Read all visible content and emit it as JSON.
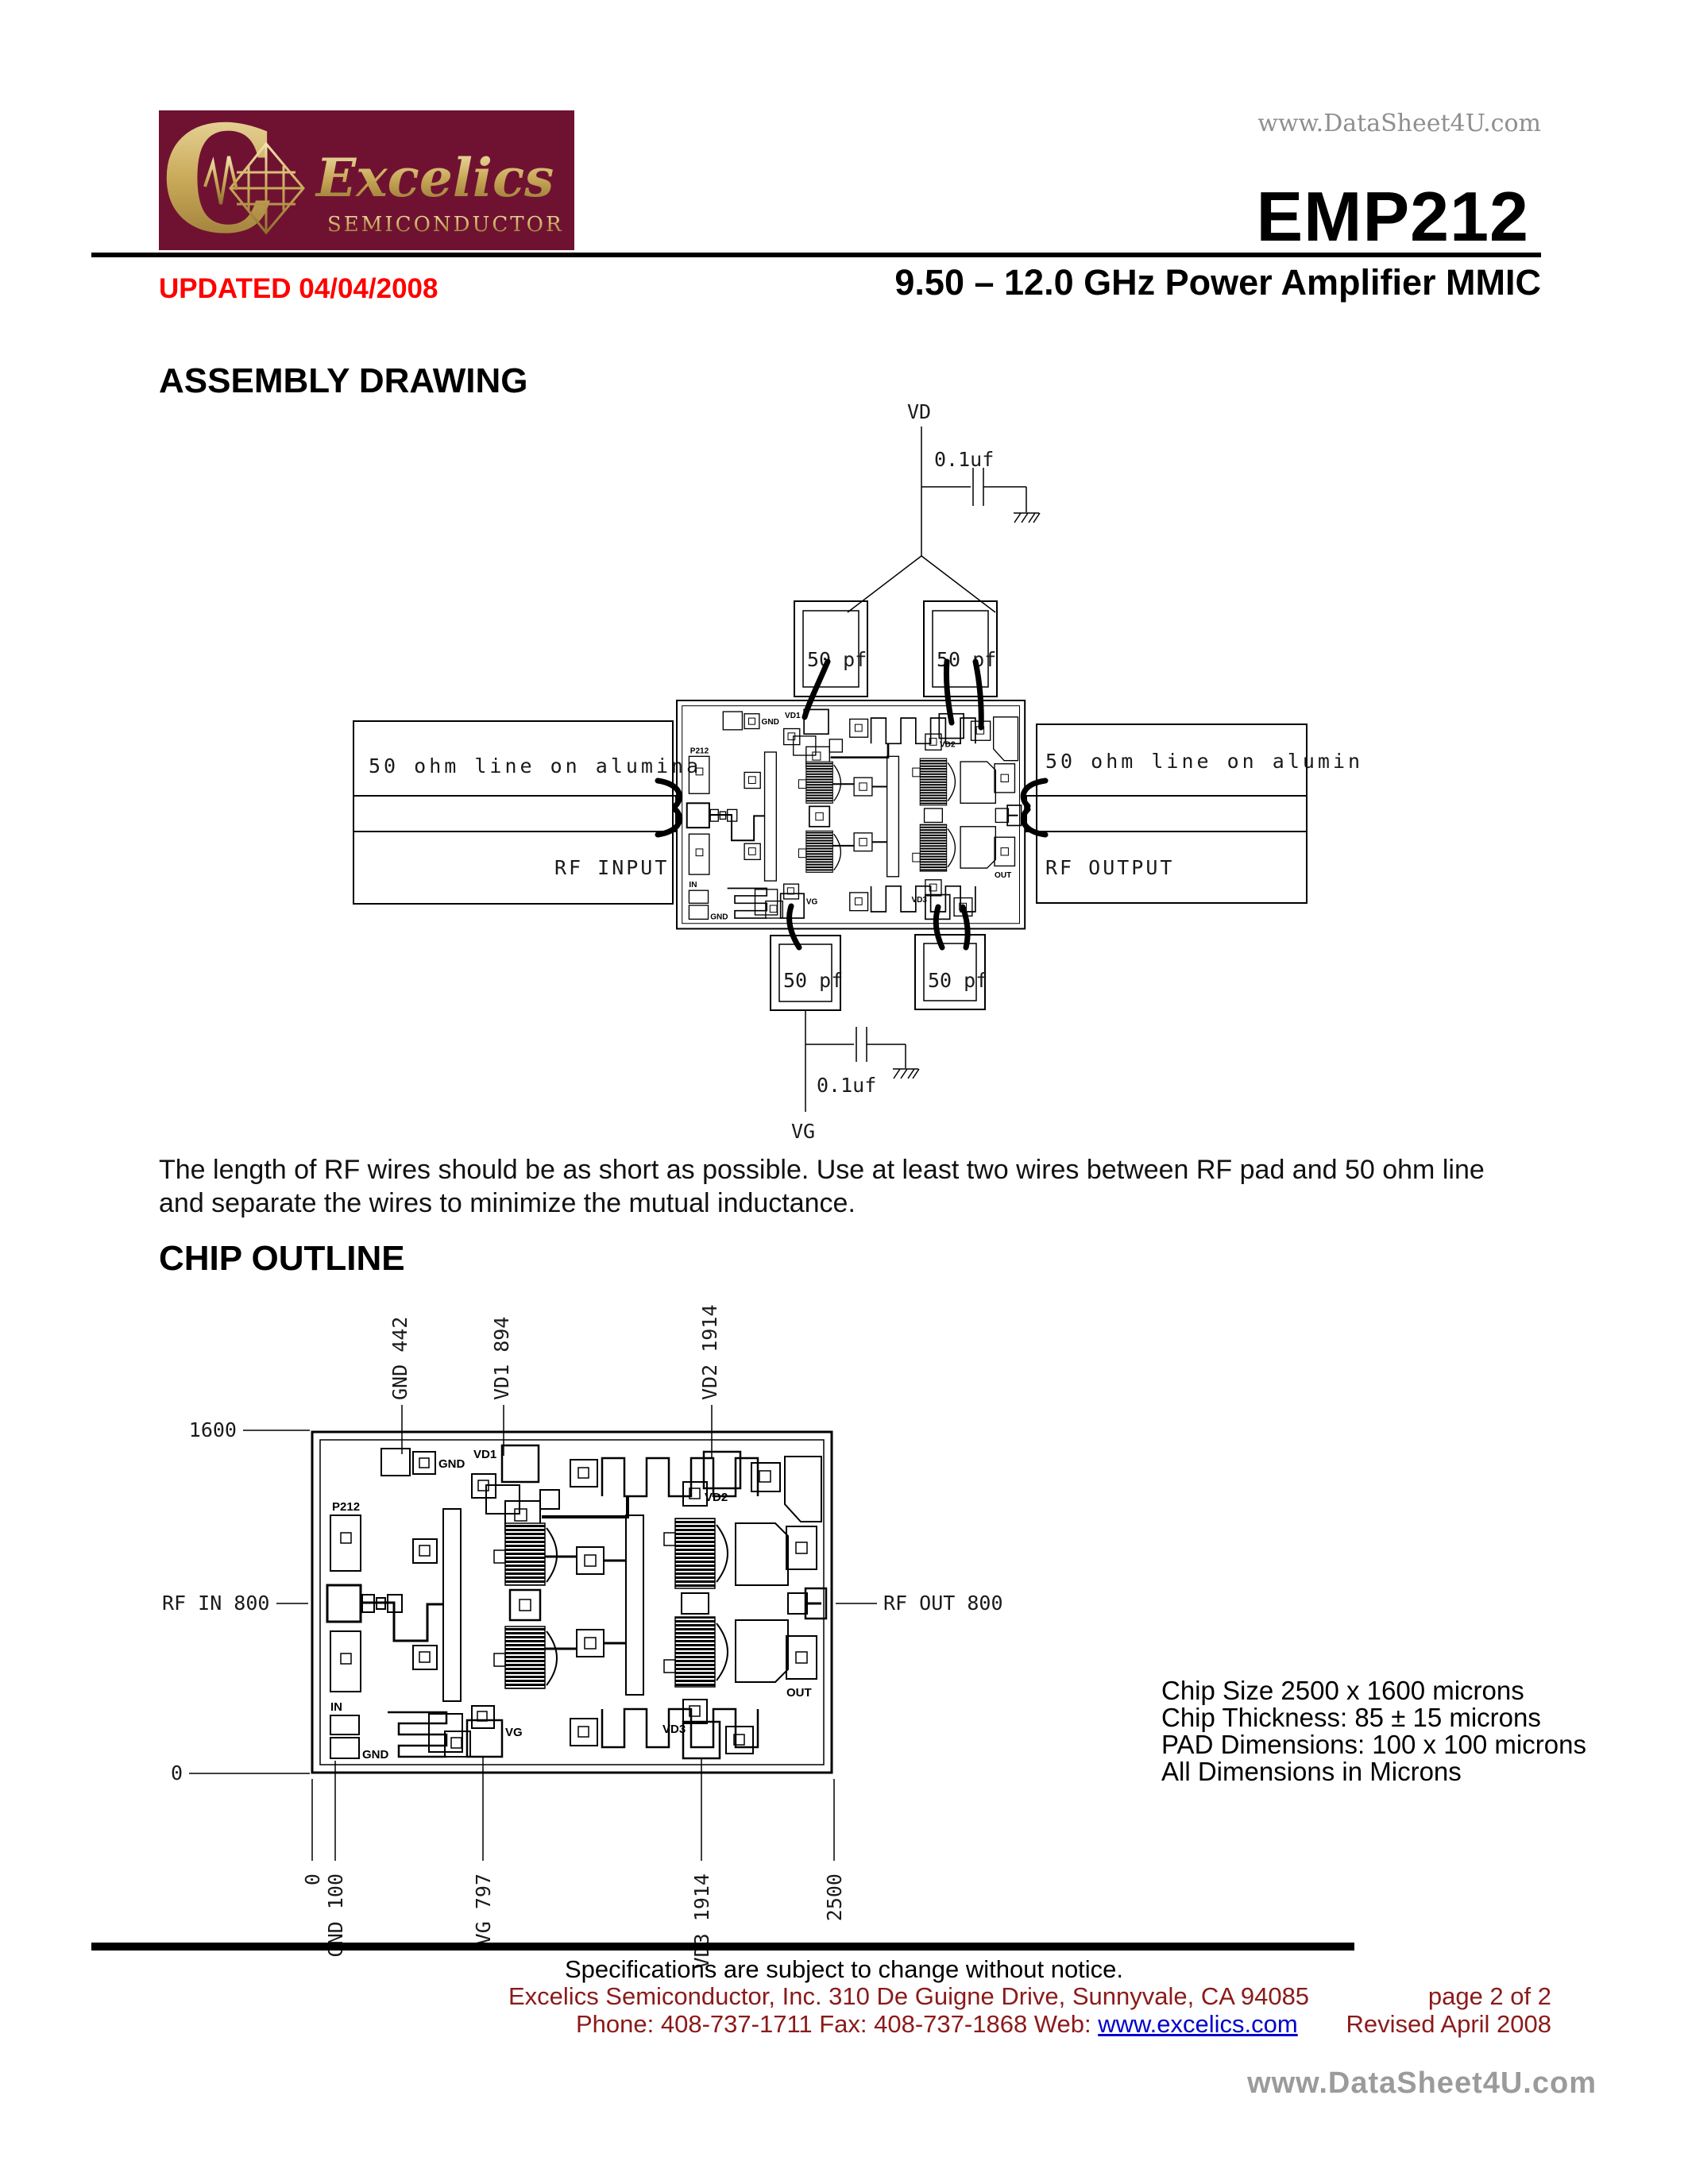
{
  "page": {
    "watermark_top": "www.DataSheet4U.com",
    "watermark_bottom": "www.DataSheet4U.com"
  },
  "header": {
    "logo_brand": "Excelics",
    "logo_sub": "SEMICONDUCTOR",
    "updated": "UPDATED 04/04/2008",
    "part_number": "EMP212",
    "subtitle": "9.50 – 12.0 GHz Power Amplifier MMIC"
  },
  "assembly": {
    "heading": "ASSEMBLY DRAWING",
    "vd_label": "VD",
    "vg_label": "VG",
    "cap_01uf_top": "0.1uf",
    "cap_01uf_bottom": "0.1uf",
    "cap_50pf": [
      "50 pf",
      "50 pf",
      "50 pf",
      "50 pf"
    ],
    "alumina_left": "50 ohm line on alumina",
    "alumina_right": "50 ohm line on alumina",
    "rf_input": "RF INPUT",
    "rf_output": "RF OUTPUT"
  },
  "note": {
    "line1": "The length of RF wires should be as short as possible. Use at least two wires between RF pad and 50 ohm line",
    "line2": "and separate the wires to minimize the mutual inductance."
  },
  "outline": {
    "heading": "CHIP OUTLINE",
    "dim_top_left": "1600",
    "dim_bottom_left": "0",
    "rf_in": "RF IN 800",
    "rf_out": "RF OUT 800",
    "top_labels": [
      "GND 442",
      "VD1 894",
      "VD2 1914"
    ],
    "bottom_labels": [
      "0",
      "GND 100",
      "VG 797",
      "VD3 1914",
      "2500"
    ],
    "info": [
      "Chip Size 2500 x 1600 microns",
      "Chip Thickness: 85 ± 15 microns",
      "PAD Dimensions: 100 x 100 microns",
      "All Dimensions in Microns"
    ]
  },
  "die": {
    "pads": {
      "p212": "P212",
      "in": "IN",
      "gnd_left": "GND",
      "gnd_top": "GND",
      "vd1": "VD1",
      "vd2": "VD2",
      "vd3": "VD3",
      "vg": "VG",
      "out": "OUT"
    }
  },
  "footer": {
    "notice": "Specifications are subject to change without notice.",
    "company": "Excelics Semiconductor, Inc.  310 De Guigne Drive, Sunnyvale, CA  94085",
    "page": "page 2 of 2",
    "phone_fax": "Phone: 408-737-1711  Fax: 408-737-1868  Web:",
    "web_link": "www.excelics.com",
    "revised": "Revised April 2008"
  },
  "colors": {
    "logo_bg": "#6F1232",
    "logo_gold": "#C9A959",
    "accent_red": "#FF0000",
    "footer_red": "#8B1A1A",
    "link_blue": "#0000CC",
    "watermark_gray": "#9B9B9B"
  }
}
